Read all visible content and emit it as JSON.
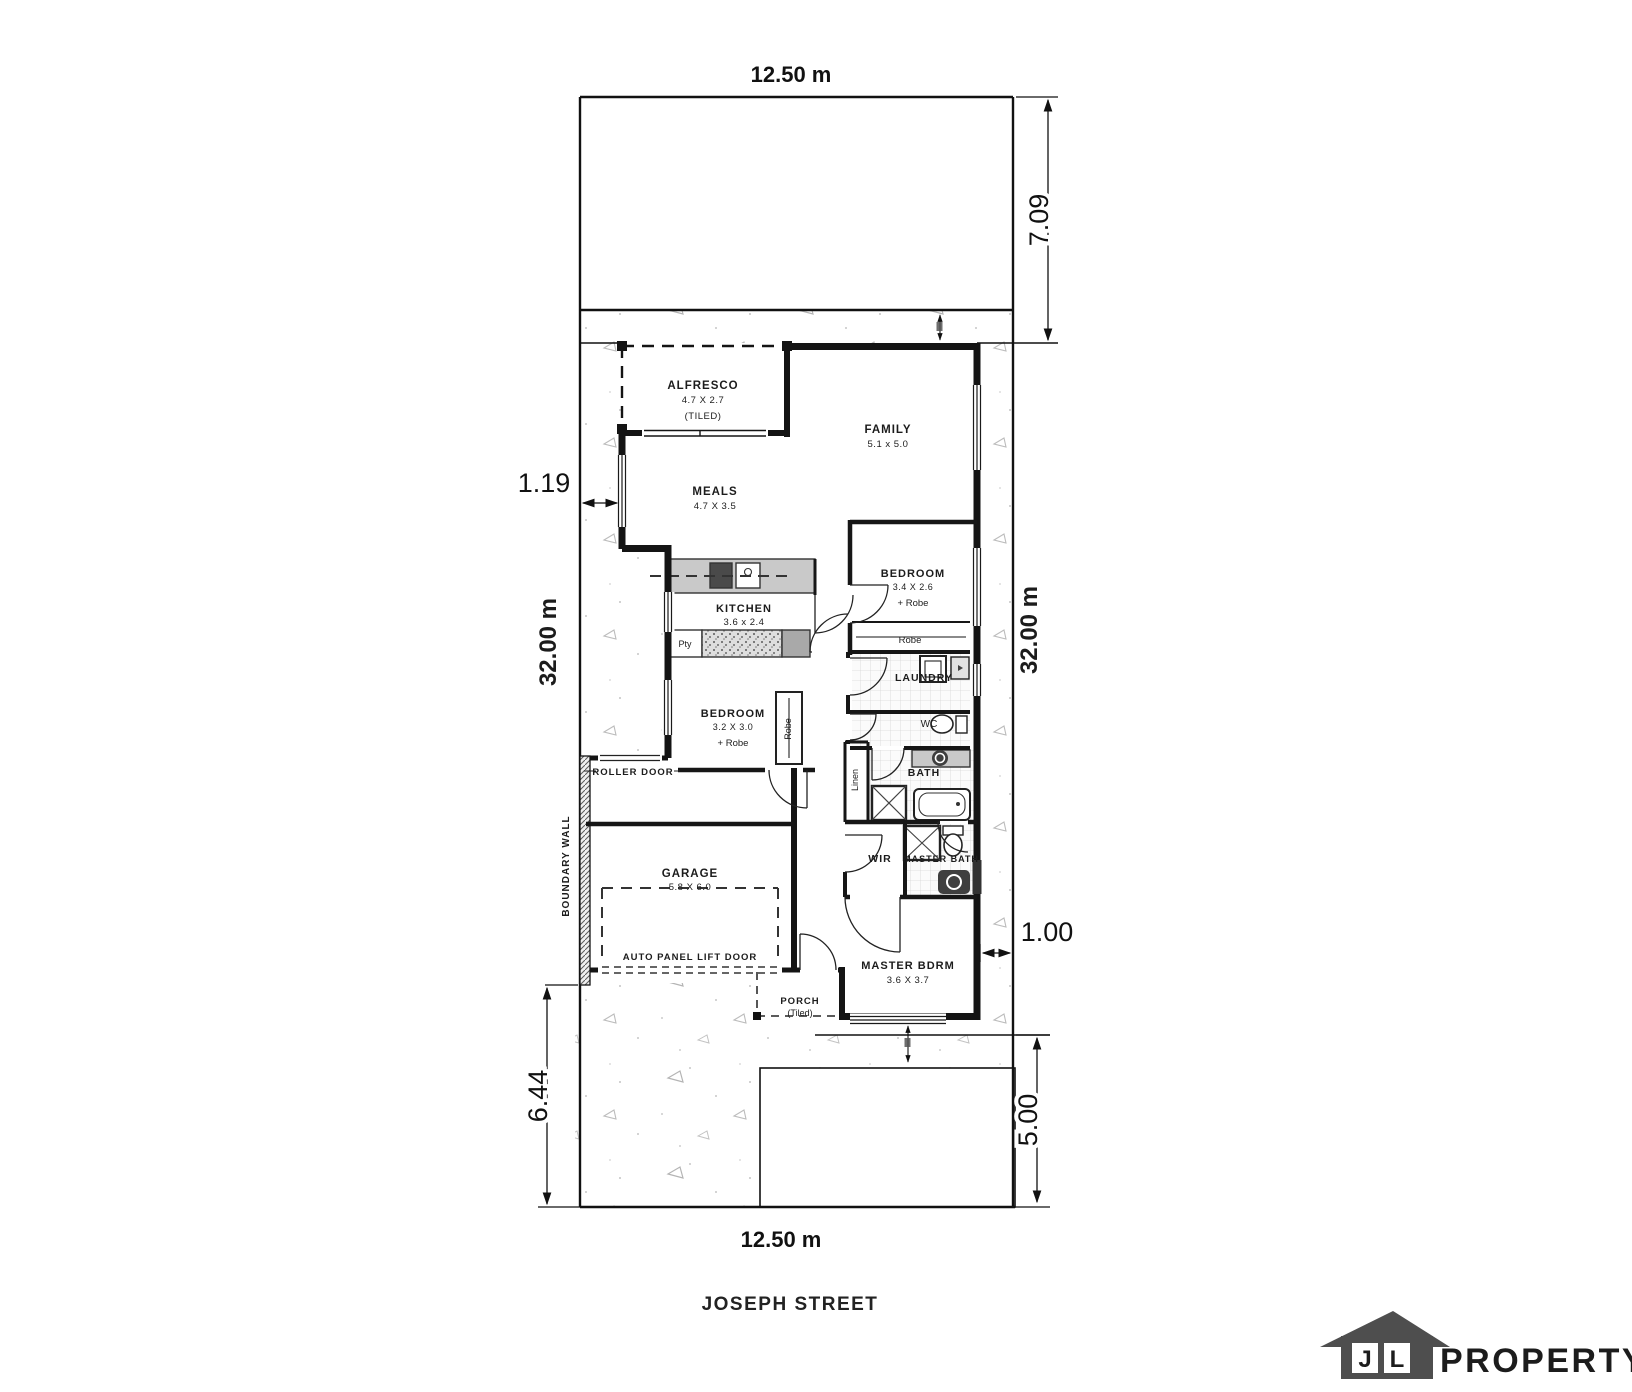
{
  "plan": {
    "dims": {
      "lot_width_top": "12.50 m",
      "lot_width_bottom": "12.50 m",
      "rear_setback": "7.09",
      "side_left_length": "32.00 m",
      "side_right_length": "32.00 m",
      "left_setback": "1.19",
      "right_setback": "1.00",
      "front_left_setback": "6.44",
      "front_right_setback": "5.00"
    },
    "street": "JOSEPH STREET",
    "rooms": {
      "alfresco": {
        "name": "ALFRESCO",
        "size": "4.7 X 2.7",
        "note": "(TILED)"
      },
      "family": {
        "name": "FAMILY",
        "size": "5.1 x 5.0"
      },
      "meals": {
        "name": "MEALS",
        "size": "4.7 X 3.5"
      },
      "kitchen": {
        "name": "KITCHEN",
        "size": "3.6 x 2.4"
      },
      "pantry": {
        "name": "Pty"
      },
      "bedroom2": {
        "name": "BEDROOM",
        "size": "3.2 X 3.0",
        "note": "+ Robe"
      },
      "bedroom3": {
        "name": "BEDROOM",
        "size": "3.4 X 2.6",
        "note": "+ Robe"
      },
      "robe": {
        "name": "Robe"
      },
      "robe_side": {
        "name": "Robe"
      },
      "laundry": {
        "name": "LAUNDRY"
      },
      "wc": {
        "name": "WC"
      },
      "bath": {
        "name": "BATH"
      },
      "linen": {
        "name": "Linen"
      },
      "wir": {
        "name": "WIR"
      },
      "master_bath": {
        "name": "MASTER BATH"
      },
      "master_bdrm": {
        "name": "MASTER BDRM",
        "size": "3.6 X 3.7"
      },
      "porch": {
        "name": "PORCH",
        "note": "(Tiled)"
      },
      "garage": {
        "name": "GARAGE",
        "size": "5.8 X 6.0"
      }
    },
    "annotations": {
      "roller_door": "ROLLER DOOR",
      "auto_door": "AUTO PANEL LIFT DOOR",
      "boundary_wall": "BOUNDARY WALL"
    }
  },
  "logo": {
    "initial_1": "J",
    "initial_2": "L",
    "word": "PROPERTY",
    "house_color": "#4e4e4e",
    "word_color": "#7c7c7c"
  }
}
